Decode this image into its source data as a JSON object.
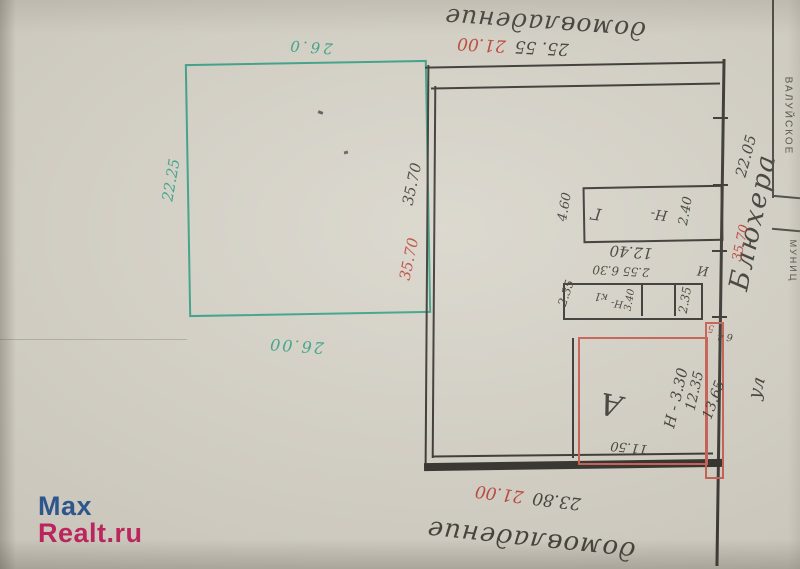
{
  "labels": {
    "top_estate": "домовладение",
    "bottom_estate": "домовладение",
    "street_prefix": "ул",
    "street_name": "Блюхера"
  },
  "dims": {
    "top_black": "25. 55",
    "top_red": "21.00",
    "bottom_black": "23.80",
    "bottom_red": "21.00",
    "green_top": "26.0",
    "green_left": "22.25",
    "green_bottom": "26.00",
    "west_black": "35.70",
    "west_red": "35.70",
    "east_black": "22.05",
    "east_red": "35.70",
    "garage": {
      "width": "4.60",
      "letter": "Г",
      "h_label": "Н-",
      "h_value": "2.40",
      "length": "12.40"
    },
    "shed": {
      "left": "2.35",
      "top": "2.55 6.30",
      "right": "2.35",
      "letter": "к1",
      "h_label": "Н-",
      "h_value": "3.40",
      "mark": "И"
    },
    "house": {
      "letter": "А",
      "height": "Н - 3.30",
      "width": "12.35",
      "side": "13.65",
      "bottom": "11.50",
      "tick_red": "5",
      "tick_black": "6 4"
    }
  },
  "stamp": {
    "line1": "ВАЛУЙСКОЕ",
    "line2": "МУНИЦ"
  },
  "logo": {
    "part1": "Max",
    "part2": "Realt.ru"
  },
  "colors": {
    "ink": "#2e2b27",
    "red": "#bb3a2e",
    "teal": "#2f9e82",
    "red_line": "#c9564a",
    "logo_blue": "#1d4d8d",
    "logo_red": "#c31457"
  }
}
